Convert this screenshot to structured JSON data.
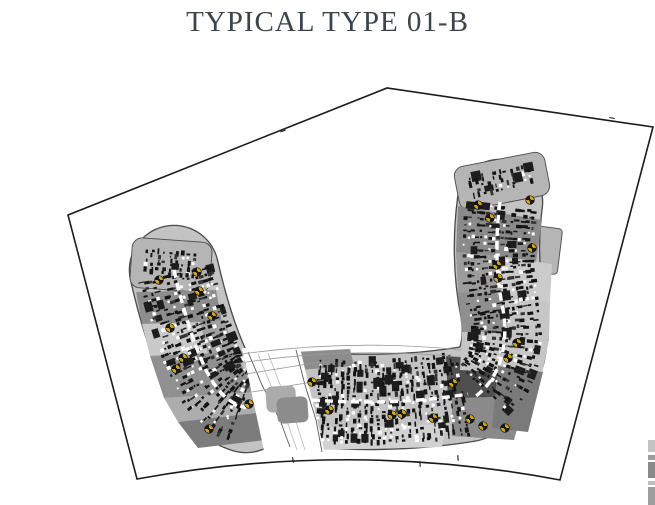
{
  "title": "TYPICAL TYPE 01-B",
  "colors": {
    "title_text": "#3d434d",
    "site_boundary": "#1b1b1b",
    "building_base": "#c3c3c3",
    "building_outline": "#4a4a4a",
    "cap_fill": "#b5b5b5",
    "detail_dark": "#141414",
    "detail_white": "#ffffff",
    "road_fill": "#ffffff",
    "road_edge": "#5a5a5a",
    "lane_line": "#b9b9b9",
    "walkway_line": "#9a9a9a",
    "stair_yellow": "#d3a900",
    "stair_black": "#161616"
  },
  "plan": {
    "boundary": {
      "points": [
        [
          68,
          215
        ],
        [
          387,
          88
        ],
        [
          653,
          127
        ],
        [
          560,
          480
        ],
        [
          137,
          479
        ]
      ],
      "bottom_ctrl": [
        350,
        440
      ],
      "ticks": [
        [
          293,
          460,
          80
        ],
        [
          420,
          464,
          85
        ],
        [
          458,
          458,
          85
        ],
        [
          612,
          118,
          10
        ],
        [
          283,
          131,
          -22
        ]
      ]
    },
    "wings": [
      {
        "name": "left-wing",
        "centerline": "M 174 270 C 182 305 192 340 206 370 C 220 398 234 404 246 408",
        "width": 88,
        "cap": {
          "cx": 171,
          "cy": 265,
          "w": 80,
          "h": 50,
          "angle": 4
        }
      },
      {
        "name": "center-block",
        "centerline": "M 312 400 C 370 404 420 402 468 394",
        "width": 94,
        "cap": null
      },
      {
        "name": "right-wing",
        "centerline": "M 500 202 C 495 240 496 275 503 310 C 509 345 500 378 476 396",
        "width": 84,
        "cap": {
          "cx": 502,
          "cy": 181,
          "w": 92,
          "h": 44,
          "angle": -11
        },
        "step": {
          "cx": 545,
          "cy": 250,
          "w": 30,
          "h": 46,
          "angle": 7
        }
      }
    ],
    "zones": [
      {
        "color": "#8d8d8d",
        "pts": [
          [
            136,
            292
          ],
          [
            216,
            290
          ],
          [
            222,
            322
          ],
          [
            142,
            324
          ]
        ]
      },
      {
        "color": "#c9c9c9",
        "pts": [
          [
            142,
            324
          ],
          [
            200,
            322
          ],
          [
            208,
            354
          ],
          [
            150,
            356
          ]
        ]
      },
      {
        "color": "#a0a0a0",
        "pts": [
          [
            200,
            322
          ],
          [
            224,
            320
          ],
          [
            236,
            352
          ],
          [
            208,
            354
          ]
        ]
      },
      {
        "color": "#909090",
        "pts": [
          [
            150,
            356
          ],
          [
            236,
            352
          ],
          [
            254,
            392
          ],
          [
            164,
            398
          ]
        ]
      },
      {
        "color": "#adadad",
        "pts": [
          [
            164,
            398
          ],
          [
            254,
            392
          ],
          [
            268,
            414
          ],
          [
            178,
            422
          ]
        ]
      },
      {
        "color": "#7c7c7c",
        "pts": [
          [
            178,
            422
          ],
          [
            266,
            412
          ],
          [
            282,
            438
          ],
          [
            198,
            448
          ]
        ]
      },
      {
        "color": "#8d8d8d",
        "pts": [
          [
            294,
            352
          ],
          [
            350,
            349
          ],
          [
            354,
            366
          ],
          [
            299,
            370
          ]
        ]
      },
      {
        "color": "#4f4f4f",
        "pts": [
          [
            446,
            356
          ],
          [
            506,
            360
          ],
          [
            504,
            402
          ],
          [
            448,
            400
          ]
        ]
      },
      {
        "color": "#8a8a8a",
        "pts": [
          [
            452,
            398
          ],
          [
            526,
            396
          ],
          [
            514,
            440
          ],
          [
            452,
            436
          ]
        ]
      },
      {
        "color": "#d2d2d2",
        "pts": [
          [
            312,
            428
          ],
          [
            446,
            424
          ],
          [
            442,
            447
          ],
          [
            318,
            450
          ]
        ]
      },
      {
        "color": "#8a8a8a",
        "pts": [
          [
            458,
            206
          ],
          [
            542,
            220
          ],
          [
            536,
            262
          ],
          [
            456,
            252
          ]
        ]
      },
      {
        "color": "#9c9c9c",
        "pts": [
          [
            456,
            252
          ],
          [
            500,
            256
          ],
          [
            502,
            294
          ],
          [
            458,
            292
          ]
        ]
      },
      {
        "color": "#cbcbcb",
        "pts": [
          [
            500,
            256
          ],
          [
            552,
            264
          ],
          [
            550,
            302
          ],
          [
            502,
            294
          ]
        ]
      },
      {
        "color": "#8f8f8f",
        "pts": [
          [
            458,
            292
          ],
          [
            504,
            294
          ],
          [
            508,
            332
          ],
          [
            462,
            332
          ]
        ]
      },
      {
        "color": "#c6c6c6",
        "pts": [
          [
            504,
            294
          ],
          [
            550,
            302
          ],
          [
            549,
            340
          ],
          [
            508,
            332
          ]
        ]
      },
      {
        "color": "#c6c6c6",
        "pts": [
          [
            462,
            332
          ],
          [
            549,
            340
          ],
          [
            542,
            374
          ],
          [
            460,
            370
          ]
        ]
      },
      {
        "color": "#7a7a7a",
        "pts": [
          [
            498,
            366
          ],
          [
            543,
            372
          ],
          [
            528,
            432
          ],
          [
            492,
            428
          ]
        ]
      }
    ],
    "road": {
      "outline": [
        [
          242,
          348
        ],
        [
          300,
          348
        ],
        [
          326,
          458
        ],
        [
          266,
          460
        ]
      ],
      "edges": [
        [
          [
            248,
            352
          ],
          [
            262,
            385
          ],
          [
            280,
            420
          ],
          [
            290,
            447
          ]
        ],
        [
          [
            296,
            350
          ],
          [
            305,
            385
          ],
          [
            316,
            420
          ],
          [
            322,
            452
          ]
        ]
      ],
      "lanes": [
        [
          [
            258,
            354
          ],
          [
            272,
            388
          ],
          [
            288,
            424
          ],
          [
            297,
            450
          ]
        ],
        [
          [
            268,
            353
          ],
          [
            281,
            387
          ],
          [
            296,
            422
          ],
          [
            305,
            450
          ]
        ]
      ]
    },
    "walkways": [
      "M 228 356 Q 345 338 462 350",
      "M 234 364 Q 345 346 460 357",
      "M 246 374 L 320 362",
      "M 252 392 L 324 380"
    ],
    "canopies": [
      {
        "x": 266,
        "y": 386,
        "w": 30,
        "h": 26,
        "angle": -4,
        "color": "#ababab"
      },
      {
        "x": 277,
        "y": 397,
        "w": 31,
        "h": 26,
        "angle": -4,
        "color": "#8c8c8c"
      }
    ],
    "stair_cores": [
      [
        159,
        280
      ],
      [
        197,
        272
      ],
      [
        199,
        291
      ],
      [
        170,
        328
      ],
      [
        183,
        358
      ],
      [
        176,
        369
      ],
      [
        212,
        316
      ],
      [
        249,
        404
      ],
      [
        209,
        429
      ],
      [
        478,
        205
      ],
      [
        490,
        218
      ],
      [
        530,
        200
      ],
      [
        532,
        248
      ],
      [
        497,
        265
      ],
      [
        498,
        278
      ],
      [
        517,
        343
      ],
      [
        508,
        358
      ],
      [
        312,
        382
      ],
      [
        329,
        410
      ],
      [
        392,
        415
      ],
      [
        433,
        418
      ],
      [
        453,
        383
      ],
      [
        470,
        419
      ],
      [
        483,
        426
      ],
      [
        402,
        414
      ],
      [
        505,
        428
      ]
    ],
    "edge_artifacts": [
      {
        "x": 648,
        "y": 440,
        "w": 7,
        "h": 12,
        "color": "#c4c4c4"
      },
      {
        "x": 648,
        "y": 455,
        "w": 7,
        "h": 5,
        "color": "#9b9b9b"
      },
      {
        "x": 648,
        "y": 462,
        "w": 7,
        "h": 16,
        "color": "#8a8a8a"
      },
      {
        "x": 648,
        "y": 481,
        "w": 7,
        "h": 4,
        "color": "#c0c0c0"
      },
      {
        "x": 648,
        "y": 487,
        "w": 7,
        "h": 18,
        "color": "#9e9e9e"
      }
    ],
    "texture": {
      "seed": 7,
      "row_step": 6,
      "cell_step": 4.2,
      "p_black": 0.58,
      "p_white": 0.14,
      "p_big": 0.055
    }
  }
}
